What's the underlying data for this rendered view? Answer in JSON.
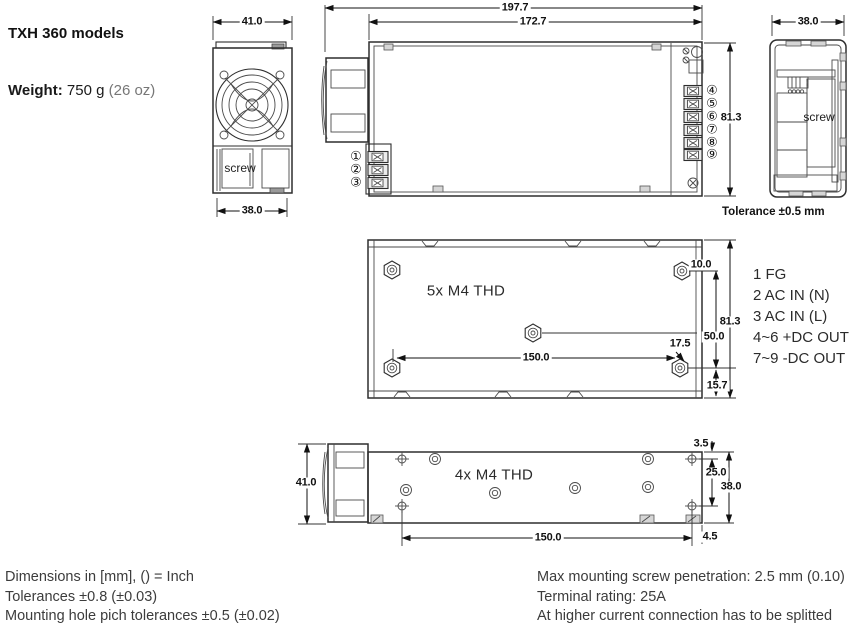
{
  "title": "TXH 360 models",
  "weight": {
    "label": "Weight:",
    "value": "750 g",
    "alt": "(26 oz)"
  },
  "front_view": {
    "dim_width_top": "41.0",
    "dim_width_bottom": "38.0",
    "screw_label": "screw"
  },
  "top_view": {
    "dim_overall_length": "197.7",
    "dim_body_length": "172.7",
    "dim_height": "81.3",
    "terminal_numbers_left": [
      "①",
      "②",
      "③"
    ],
    "terminal_numbers_right": [
      "④",
      "⑤",
      "⑥",
      "⑦",
      "⑧",
      "⑨"
    ]
  },
  "end_view": {
    "dim_width": "38.0",
    "screw_label": "screw"
  },
  "tolerance_note": "Tolerance ±0.5 mm",
  "bottom_view": {
    "thread_label": "5x M4 THD",
    "dim_hole_edge": "10.0",
    "dim_height": "81.3",
    "dim_hole_span": "50.0",
    "dim_center_offset": "17.5",
    "dim_hole_pitch": "150.0",
    "dim_flange": "15.7"
  },
  "side_view": {
    "thread_label": "4x M4 THD",
    "dim_height_overall": "41.0",
    "dim_top_offset": "3.5",
    "dim_hole_span": "25.0",
    "dim_height_body": "38.0",
    "dim_hole_pitch": "150.0",
    "dim_edge_offset": "4.5"
  },
  "terminal_legend": [
    "1 FG",
    "2 AC IN (N)",
    "3 AC IN (L)",
    "4~6 +DC OUT",
    "7~9 -DC OUT"
  ],
  "notes_left": [
    "Dimensions in [mm], () = Inch",
    "Tolerances  ±0.8 (±0.03)",
    "Mounting hole pich tolerances ±0.5 (±0.02)"
  ],
  "notes_right": [
    "Max mounting screw penetration: 2.5 mm (0.10)",
    "Terminal rating: 25A",
    "At higher current connection has to be splitted"
  ]
}
